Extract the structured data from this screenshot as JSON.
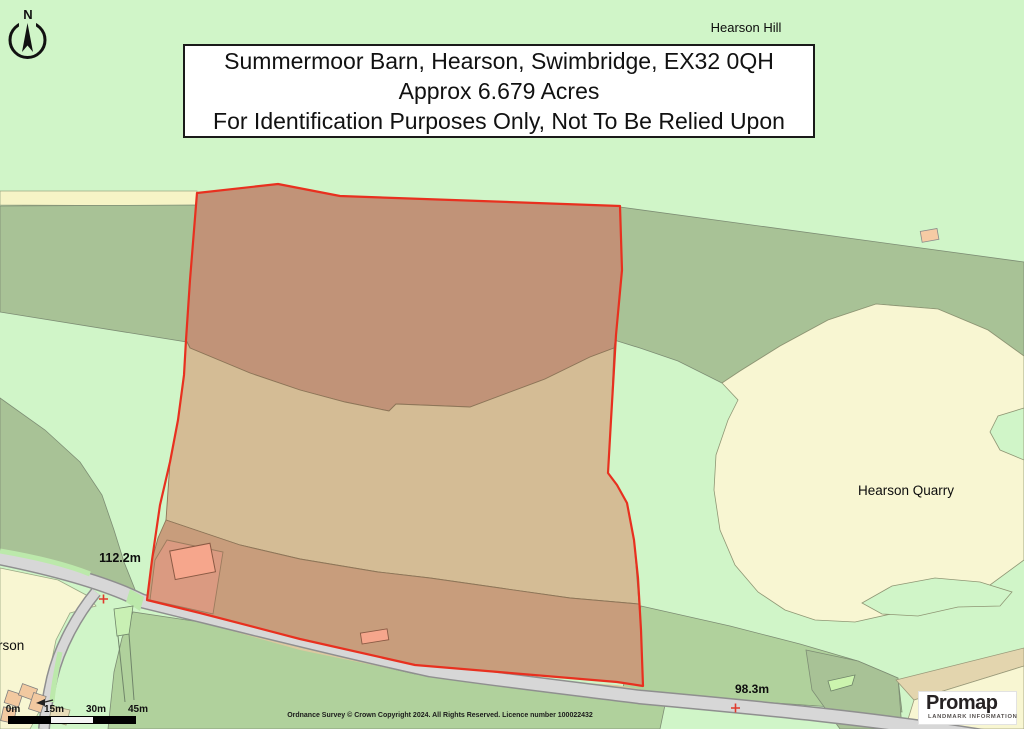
{
  "title_box": {
    "line1": "Summermoor Barn, Hearson, Swimbridge, EX32 0QH",
    "line2": "Approx 6.679 Acres",
    "line3": "For Identification Purposes Only, Not To Be Relied Upon"
  },
  "north_arrow": {
    "label": "N"
  },
  "map_labels": {
    "hearson_hill": "Hearson Hill",
    "hearson_quarry": "Hearson Quarry",
    "spot_height_west": "112.2m",
    "spot_height_south": "98.3m",
    "partial_place_name": "rson"
  },
  "scale_bar": {
    "ticks": [
      "0m",
      "15m",
      "30m",
      "45m"
    ]
  },
  "footer": {
    "copyright": "Ordnance Survey © Crown Copyright 2024. All Rights Reserved. Licence number 100022432"
  },
  "logo": {
    "brand": "Promap",
    "tagline": "LANDMARK INFORMATION"
  },
  "colors": {
    "boundary_red": "#e8301f",
    "parcel_top_field": "#c19378",
    "parcel_middle_field": "#d4bc95",
    "parcel_bottom_strip": "#c89d7c",
    "barn_plot_salmon": "#da9a81",
    "building_salmon": "#f6a68c",
    "quarry_yellow": "#f8f6d2",
    "mint_green": "#d0f5c8",
    "sage_green": "#a8c296",
    "field_green": "#b0d19c",
    "road_gray": "#d7d7d7",
    "logo_orange": "#f7a600"
  }
}
